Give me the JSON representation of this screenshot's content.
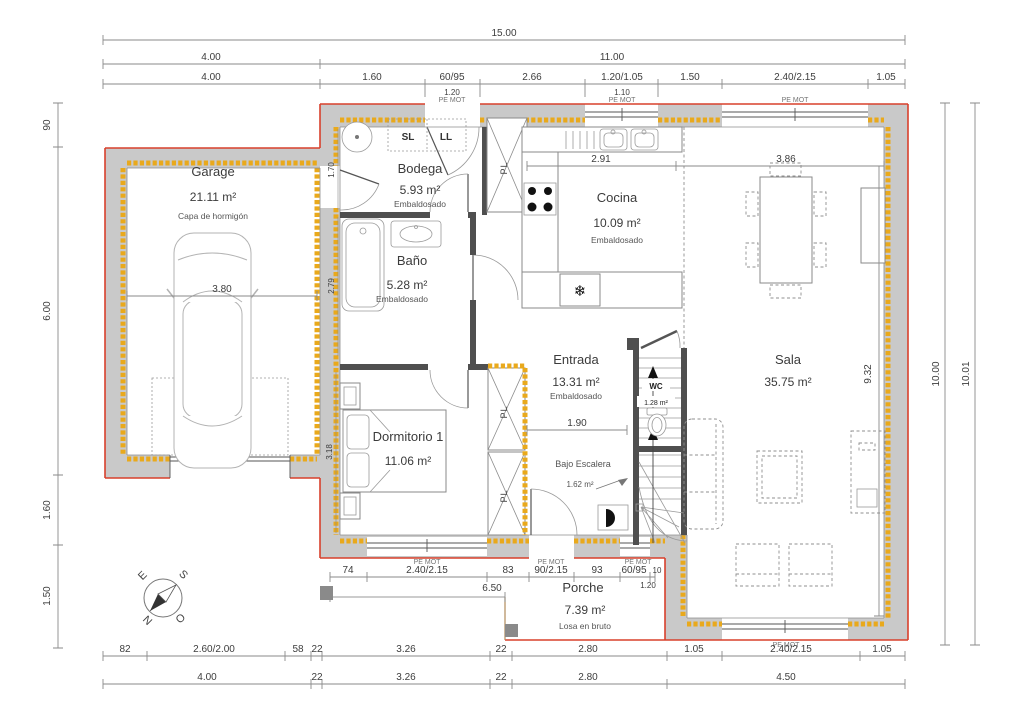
{
  "colors": {
    "exterior_outline": "#d8402c",
    "wall_fill": "#c9c9c9",
    "insulation_hatch": "#e9a91c",
    "interior_wall": "#4f4f4f"
  },
  "labels": {
    "window_type": "PE MOT",
    "closet": "PL",
    "washer": "SL",
    "dryer": "LL",
    "fridge_icon": "❄"
  },
  "rooms": {
    "garage": {
      "name": "Garage",
      "area": "21.11 m²",
      "floor": "Capa de hormigón"
    },
    "bodega": {
      "name": "Bodega",
      "area": "5.93 m²",
      "floor": "Embaldosado"
    },
    "bano": {
      "name": "Baño",
      "area": "5.28 m²",
      "floor": "Embaldosado"
    },
    "cocina": {
      "name": "Cocina",
      "area": "10.09 m²",
      "floor": "Embaldosado"
    },
    "entrada": {
      "name": "Entrada",
      "area": "13.31 m²",
      "floor": "Embaldosado"
    },
    "dormitorio1": {
      "name": "Dormitorio 1",
      "area": "11.06 m²"
    },
    "sala": {
      "name": "Sala",
      "area": "35.75 m²"
    },
    "wc": {
      "name": "WC",
      "area": "1.28 m²"
    },
    "bajo_escalera": {
      "name": "Bajo Escalera",
      "area": "1.62 m²"
    },
    "porche": {
      "name": "Porche",
      "area": "7.39 m²",
      "floor": "Losa en bruto"
    }
  },
  "dims": {
    "top_total": "15.00",
    "top_row2": [
      "4.00",
      "11.00"
    ],
    "top_row3": [
      "4.00",
      "1.60",
      "60/95",
      "2.66",
      "1.20/1.05",
      "1.50",
      "2.40/2.15",
      "1.05"
    ],
    "top_sub": [
      "1.20",
      "1.10"
    ],
    "left": [
      "90",
      "6.00",
      "1.60",
      "1.50"
    ],
    "right": [
      "10.00",
      "10.01"
    ],
    "inner": {
      "garage_w": "3.80",
      "cocina_w": "2.91",
      "sala_w": "3.86",
      "sala_h": "9.32",
      "entrada_w": "1.90",
      "bodega_h": "1.70",
      "bano_h": "2.79",
      "dorm_h": "3.18",
      "porch_off": "6.50"
    },
    "door_row": [
      "74",
      "2.40/2.15",
      "83",
      "90/2.15",
      "93",
      "60/95",
      "10"
    ],
    "door_row_sub": "1.20",
    "bottom_row1": [
      "82",
      "2.60/2.00",
      "58",
      "22",
      "3.26",
      "22",
      "2.80",
      "1.05",
      "2.40/2.15",
      "1.05"
    ],
    "bottom_row2": [
      "4.00",
      "22",
      "3.26",
      "22",
      "2.80",
      "4.50"
    ]
  },
  "compass": {
    "e": "E",
    "s": "S",
    "n": "N",
    "o": "O"
  }
}
